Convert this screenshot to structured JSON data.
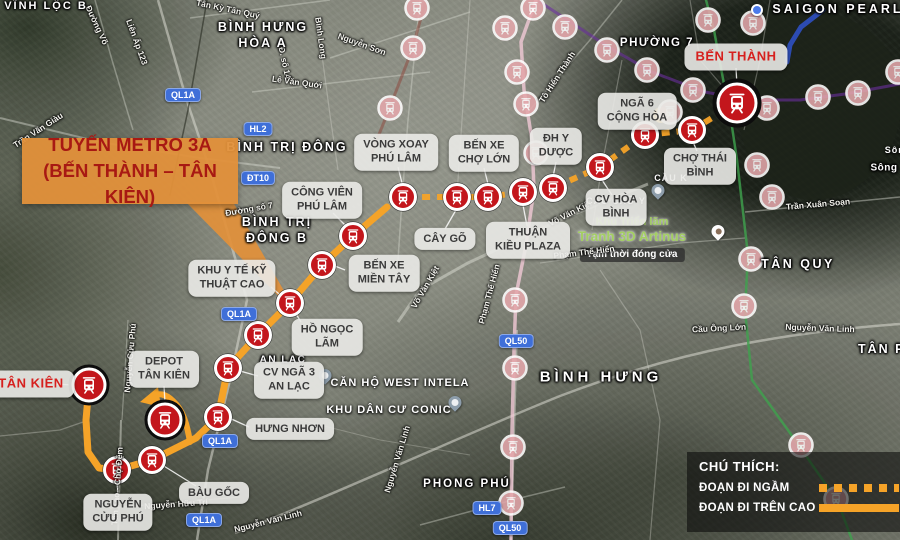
{
  "callout": {
    "line1": "TUYẾN METRO 3A",
    "line2": "(BẾN THÀNH – TÂN KIÊN)",
    "bg": "#e2903a",
    "pointer": [
      [
        186,
        202
      ],
      [
        233,
        202
      ],
      [
        299,
        317
      ]
    ]
  },
  "legend": {
    "title": "CHÚ THÍCH:",
    "items": [
      {
        "label": "ĐOẠN ĐI NGẦM",
        "style": "dashed"
      },
      {
        "label": "ĐOẠN ĐI TRÊN CAO",
        "style": "solid"
      }
    ]
  },
  "colors": {
    "route_orange": "#f5a328",
    "station_red": "#c3161c",
    "faded_pink": "#e4a7ab",
    "badge_blue": "#3f6fd8",
    "callout_text": "#a81913"
  },
  "route": {
    "color": "#f5a328",
    "dotted": [
      [
        737,
        103
      ],
      [
        692,
        130
      ],
      [
        645,
        135
      ],
      [
        600,
        167
      ],
      [
        553,
        188
      ],
      [
        523,
        192
      ],
      [
        488,
        197
      ],
      [
        457,
        197
      ],
      [
        403,
        197
      ],
      [
        387,
        207
      ]
    ],
    "solid": [
      [
        387,
        207
      ],
      [
        353,
        236
      ],
      [
        322,
        265
      ],
      [
        290,
        303
      ],
      [
        258,
        335
      ],
      [
        228,
        368
      ],
      [
        218,
        417
      ],
      [
        196,
        438
      ],
      [
        152,
        460
      ],
      [
        117,
        470
      ],
      [
        99,
        468
      ],
      [
        88,
        452
      ],
      [
        86,
        420
      ],
      [
        89,
        385
      ]
    ],
    "depot_branch": "M190,442 C187,424 183,410 173,401 C166,394 158,392 152,397",
    "arrow": [
      [
        140,
        402
      ],
      [
        158,
        387
      ],
      [
        161,
        407
      ]
    ]
  },
  "stations": {
    "terminals": [
      {
        "name": "Bến Thành",
        "x": 737,
        "y": 103,
        "r": 19,
        "glyph": 24,
        "ring": 5
      },
      {
        "name": "Tân Kiên",
        "x": 89,
        "y": 385,
        "r": 16,
        "glyph": 20,
        "ring": 4
      },
      {
        "name": "Depot Tân Kiên",
        "x": 165,
        "y": 420,
        "r": 16,
        "glyph": 20,
        "ring": 4
      }
    ],
    "line": [
      [
        692,
        130
      ],
      [
        645,
        135
      ],
      [
        600,
        167
      ],
      [
        553,
        188
      ],
      [
        523,
        192
      ],
      [
        488,
        197
      ],
      [
        457,
        197
      ],
      [
        403,
        197
      ],
      [
        353,
        236
      ],
      [
        322,
        265
      ],
      [
        290,
        303
      ],
      [
        258,
        335
      ],
      [
        228,
        368
      ],
      [
        218,
        417
      ],
      [
        152,
        460
      ],
      [
        117,
        470
      ]
    ],
    "faded": [
      [
        417,
        8
      ],
      [
        413,
        48
      ],
      [
        390,
        108
      ],
      [
        533,
        8
      ],
      [
        505,
        28
      ],
      [
        517,
        72
      ],
      [
        526,
        104
      ],
      [
        536,
        153
      ],
      [
        515,
        300
      ],
      [
        515,
        368
      ],
      [
        513,
        447
      ],
      [
        511,
        503
      ],
      [
        565,
        27
      ],
      [
        607,
        50
      ],
      [
        647,
        70
      ],
      [
        693,
        90
      ],
      [
        670,
        112
      ],
      [
        708,
        20
      ],
      [
        753,
        23
      ],
      [
        767,
        108
      ],
      [
        757,
        165
      ],
      [
        772,
        197
      ],
      [
        751,
        259
      ],
      [
        744,
        306
      ],
      [
        801,
        445
      ],
      [
        836,
        499
      ],
      [
        818,
        97
      ],
      [
        858,
        93
      ],
      [
        898,
        72
      ]
    ]
  },
  "station_labels": [
    {
      "lines": [
        "BẾN THÀNH"
      ],
      "x": 736,
      "y": 57,
      "red": true
    },
    {
      "lines": [
        "NGÃ 6",
        "CỘNG HÒA"
      ],
      "x": 637,
      "y": 111
    },
    {
      "lines": [
        "CHỢ THÁI",
        "BÌNH"
      ],
      "x": 700,
      "y": 166
    },
    {
      "lines": [
        "ĐH Y",
        "DƯỢC"
      ],
      "x": 556,
      "y": 146
    },
    {
      "lines": [
        "BẾN XE",
        "CHỢ LỚN"
      ],
      "x": 484,
      "y": 153
    },
    {
      "lines": [
        "VÒNG XOAY",
        "PHÚ LÂM"
      ],
      "x": 396,
      "y": 152
    },
    {
      "lines": [
        "CÔNG VIÊN",
        "PHÚ LÂM"
      ],
      "x": 322,
      "y": 200
    },
    {
      "lines": [
        "CÂY GÕ"
      ],
      "x": 445,
      "y": 239
    },
    {
      "lines": [
        "THUẬN",
        "KIỀU PLAZA"
      ],
      "x": 528,
      "y": 240
    },
    {
      "lines": [
        "CV HÒA",
        "BÌNH"
      ],
      "x": 616,
      "y": 207
    },
    {
      "lines": [
        "BẾN XE",
        "MIỀN TÂY"
      ],
      "x": 384,
      "y": 273
    },
    {
      "lines": [
        "KHU Y TẾ KỸ",
        "THUẬT CAO"
      ],
      "x": 232,
      "y": 278
    },
    {
      "lines": [
        "HỒ NGỌC",
        "LÃM"
      ],
      "x": 327,
      "y": 337
    },
    {
      "lines": [
        "CV NGÃ 3",
        "AN LẠC"
      ],
      "x": 289,
      "y": 380
    },
    {
      "lines": [
        "HƯNG NHƠN"
      ],
      "x": 290,
      "y": 429
    },
    {
      "lines": [
        "BÀU GỐC"
      ],
      "x": 214,
      "y": 493
    },
    {
      "lines": [
        "NGUYỄN",
        "CỬU PHÚ"
      ],
      "x": 118,
      "y": 512
    },
    {
      "lines": [
        "DEPOT",
        "TÂN KIÊN"
      ],
      "x": 164,
      "y": 369
    },
    {
      "lines": [
        "TÂN KIÊN"
      ],
      "x": 31,
      "y": 384,
      "red": true
    }
  ],
  "leaders": [
    [
      736,
      68,
      737,
      86
    ],
    [
      697,
      151,
      693,
      142
    ],
    [
      556,
      162,
      553,
      177
    ],
    [
      484,
      168,
      488,
      184
    ],
    [
      398,
      167,
      403,
      187
    ],
    [
      445,
      229,
      456,
      210
    ],
    [
      527,
      226,
      523,
      205
    ],
    [
      612,
      195,
      602,
      180
    ],
    [
      333,
      213,
      349,
      229
    ],
    [
      345,
      270,
      335,
      266
    ],
    [
      271,
      287,
      286,
      300
    ],
    [
      301,
      322,
      293,
      309
    ],
    [
      258,
      376,
      233,
      369
    ],
    [
      249,
      427,
      227,
      417
    ],
    [
      196,
      486,
      159,
      463
    ],
    [
      118,
      499,
      117,
      481
    ],
    [
      164,
      386,
      165,
      403
    ],
    [
      55,
      384,
      72,
      385
    ]
  ],
  "place_names": [
    {
      "text": "VĨNH LỘC B",
      "x": 46,
      "y": 6,
      "size": 11,
      "ls": 2
    },
    {
      "text": "BÌNH HƯNG",
      "x": 263,
      "y": 27,
      "size": 12.5,
      "ls": 2
    },
    {
      "text": "HÒA A",
      "x": 263,
      "y": 43,
      "size": 12.5,
      "ls": 2
    },
    {
      "text": "PHƯỜNG 7",
      "x": 657,
      "y": 43,
      "size": 11.5,
      "ls": 1.5
    },
    {
      "text": "SAIGON PEARL",
      "x": 838,
      "y": 9,
      "size": 12.5,
      "ls": 3
    },
    {
      "text": "BÌNH TRỊ ĐÔNG",
      "x": 287,
      "y": 147,
      "size": 12.5,
      "ls": 2
    },
    {
      "text": "BÌNH TRỊ",
      "x": 277,
      "y": 222,
      "size": 12.5,
      "ls": 2
    },
    {
      "text": "ĐÔNG B",
      "x": 277,
      "y": 238,
      "size": 12.5,
      "ls": 2
    },
    {
      "text": "TÂN QUY",
      "x": 798,
      "y": 264,
      "size": 12.5,
      "ls": 2.5
    },
    {
      "text": "BÌNH HƯNG",
      "x": 601,
      "y": 377,
      "size": 15,
      "ls": 4
    },
    {
      "text": "PHONG PHÚ",
      "x": 467,
      "y": 484,
      "size": 11.5,
      "ls": 2
    },
    {
      "text": "TÂN PHONG",
      "x": 858,
      "y": 349,
      "size": 12.5,
      "ls": 2,
      "anchor": "left"
    },
    {
      "text": "AN LẠC",
      "x": 283,
      "y": 360,
      "size": 10,
      "ls": 1.5
    },
    {
      "text": "Sông",
      "x": 884,
      "y": 168,
      "size": 10,
      "ls": 0.5
    }
  ],
  "road_labels": [
    {
      "t": "Trần Văn Giàu",
      "x": 38,
      "y": 130,
      "r": -33
    },
    {
      "t": "Đường Võ",
      "x": 97,
      "y": 25,
      "r": 65
    },
    {
      "t": "Liên Ấp 123",
      "x": 137,
      "y": 42,
      "r": 70
    },
    {
      "t": "Tân Kỳ Tân Quý",
      "x": 228,
      "y": 9,
      "r": 12
    },
    {
      "t": "Đ. số 14",
      "x": 285,
      "y": 63,
      "r": 78
    },
    {
      "t": "Bình Long",
      "x": 321,
      "y": 38,
      "r": 82
    },
    {
      "t": "Nguyễn Sơn",
      "x": 362,
      "y": 44,
      "r": 20
    },
    {
      "t": "Lê Văn Quới",
      "x": 297,
      "y": 82,
      "r": 8
    },
    {
      "t": "Tô Hiến Thành",
      "x": 557,
      "y": 77,
      "r": -57
    },
    {
      "t": "Đường số 7",
      "x": 249,
      "y": 209,
      "r": -10
    },
    {
      "t": "Võ Văn Kiệt",
      "x": 425,
      "y": 287,
      "r": -60
    },
    {
      "t": "Võ Văn Kiệt",
      "x": 570,
      "y": 213,
      "r": -27
    },
    {
      "t": "Trần Xuân Soạn",
      "x": 818,
      "y": 204,
      "r": -5
    },
    {
      "t": "Nguyễn Văn Linh",
      "x": 820,
      "y": 328,
      "r": 2
    },
    {
      "t": "Cầu Ông Lớn",
      "x": 719,
      "y": 328,
      "r": -3
    },
    {
      "t": "Nguyễn Văn Linh",
      "x": 268,
      "y": 521,
      "r": -14
    },
    {
      "t": "Nguyễn Hữu Trí",
      "x": 176,
      "y": 504,
      "r": -4
    },
    {
      "t": "Nguyễn Cửu Phú",
      "x": 130,
      "y": 358,
      "r": -85
    },
    {
      "t": "Tân Tạo - Chợ Đệm",
      "x": 117,
      "y": 486,
      "r": -86
    },
    {
      "t": "Phạm Thế Hiển",
      "x": 584,
      "y": 252,
      "r": -7
    },
    {
      "t": "Phạm Thế Hiển",
      "x": 489,
      "y": 294,
      "r": -75
    },
    {
      "t": "Nguyễn Văn Linh",
      "x": 397,
      "y": 459,
      "r": -73
    }
  ],
  "badges": [
    {
      "t": "QL1A",
      "x": 183,
      "y": 95
    },
    {
      "t": "QL1A",
      "x": 239,
      "y": 314
    },
    {
      "t": "QL1A",
      "x": 220,
      "y": 441
    },
    {
      "t": "QL1A",
      "x": 204,
      "y": 520
    },
    {
      "t": "HL2",
      "x": 258,
      "y": 129
    },
    {
      "t": "ĐT10",
      "x": 258,
      "y": 178
    },
    {
      "t": "QL50",
      "x": 516,
      "y": 341
    },
    {
      "t": "QL50",
      "x": 510,
      "y": 528
    },
    {
      "t": "HL7",
      "x": 487,
      "y": 508
    }
  ],
  "poi": {
    "artinus": {
      "line1": "Khu Triển lãm",
      "line2": "Tranh 3D Artinus",
      "line3": "Tạm thời đóng cửa"
    }
  },
  "poi_texts": [
    {
      "text": "CĂN HỘ WEST INTELA",
      "x": 400,
      "y": 383,
      "size": 11
    },
    {
      "text": "KHU DÂN CƯ CONIC",
      "x": 389,
      "y": 410,
      "size": 11
    },
    {
      "text": "CẦU CHỮ Y",
      "x": 616,
      "y": 201,
      "size": 9
    },
    {
      "text": "CẦU K",
      "x": 671,
      "y": 178,
      "size": 9
    },
    {
      "text": "Sông",
      "x": 898,
      "y": 150,
      "size": 9
    }
  ],
  "pins": [
    {
      "x": 325,
      "y": 382,
      "kind": "grey",
      "name": "west-intela-pin"
    },
    {
      "x": 455,
      "y": 409,
      "kind": "grey",
      "name": "conic-pin"
    },
    {
      "x": 658,
      "y": 197,
      "kind": "grey",
      "name": "bridge-pin"
    },
    {
      "x": 718,
      "y": 238,
      "kind": "palette",
      "name": "artinus-pin"
    },
    {
      "x": 757,
      "y": 10,
      "kind": "blue",
      "name": "poi-pin"
    }
  ],
  "map": {
    "roundabout": [
      661,
      115
    ],
    "water": [
      "M742,12 C810,-5 880,18 898,70 C912,118 888,178 838,196 C788,212 748,176 740,128 C736,94 734,40 742,12 Z"
    ],
    "roads": [
      {
        "d": "M158,0 L186,98 L210,170 L247,300 L230,380 L208,470 L197,540",
        "w": 2.5,
        "o": 0.55
      },
      {
        "d": "M648,184 L560,220 L468,263 L420,290 L398,322",
        "w": 3,
        "o": 0.5
      },
      {
        "d": "M900,324 C790,332 680,350 560,396 C470,432 330,497 235,533",
        "w": 2.5,
        "o": 0.55
      },
      {
        "d": "M517,330 L511,540",
        "w": 2,
        "o": 0.5
      },
      {
        "d": "M420,0 L408,120 L402,200 L398,260",
        "w": 1.5,
        "o": 0.4
      },
      {
        "d": "M470,0 L462,120 L457,195",
        "w": 1.2,
        "o": 0.35
      },
      {
        "d": "M622,60 L602,165 L592,230",
        "w": 1.2,
        "o": 0.35
      },
      {
        "d": "M252,92 L430,72",
        "w": 1.5,
        "o": 0.4
      },
      {
        "d": "M330,58 L470,12",
        "w": 1.5,
        "o": 0.4
      },
      {
        "d": "M190,18 L330,0",
        "w": 1.5,
        "o": 0.4
      },
      {
        "d": "M317,18 L330,115 L338,170",
        "w": 1.2,
        "o": 0.35
      },
      {
        "d": "M0,118 L100,142 L200,158 L280,168",
        "w": 2,
        "o": 0.45
      },
      {
        "d": "M528,112 L590,40 L622,0",
        "w": 1.5,
        "o": 0.4
      },
      {
        "d": "M745,212 L900,197",
        "w": 1.5,
        "o": 0.45
      },
      {
        "d": "M540,263 L680,243 L745,238",
        "w": 1.2,
        "o": 0.4
      },
      {
        "d": "M420,525 L520,498 L565,487",
        "w": 1.5,
        "o": 0.4
      },
      {
        "d": "M110,508 L240,497",
        "w": 1.2,
        "o": 0.4
      },
      {
        "d": "M121,420 L118,540",
        "w": 2,
        "o": 0.5
      },
      {
        "d": "M95,0 L112,60 L133,130",
        "w": 1.5,
        "o": 0.4
      },
      {
        "d": "M0,436 L60,430 L86,421",
        "w": 1.2,
        "o": 0.35
      },
      {
        "d": "M128,320 L122,420",
        "w": 1.2,
        "o": 0.4
      },
      {
        "d": "M770,0 L760,60 L744,130",
        "w": 1.2,
        "o": 0.35
      },
      {
        "d": "M600,270 L640,330 L660,420 L650,540",
        "w": 1.2,
        "o": 0.35
      },
      {
        "d": "M300,420 L380,440 L470,455",
        "w": 1,
        "o": 0.3
      },
      {
        "d": "M737,103 L700,60 L690,0",
        "w": 1.2,
        "o": 0.35
      }
    ]
  },
  "other_lines": [
    {
      "pts": [
        [
          207,
          0
        ],
        [
          188,
          110
        ],
        [
          170,
          195
        ]
      ],
      "c": "#26291f",
      "w": 1.5,
      "o": 0.6
    },
    {
      "pts": [
        [
          426,
          0
        ],
        [
          412,
          50
        ],
        [
          388,
          112
        ],
        [
          372,
          152
        ]
      ],
      "c": "#8d4b40",
      "w": 3,
      "o": 0.55
    },
    {
      "pts": [
        [
          536,
          0
        ],
        [
          521,
          42
        ],
        [
          524,
          90
        ],
        [
          532,
          140
        ],
        [
          534,
          190
        ],
        [
          526,
          245
        ],
        [
          516,
          295
        ],
        [
          514,
          350
        ],
        [
          512,
          430
        ],
        [
          511,
          540
        ]
      ],
      "c": "#f1c9d6",
      "w": 3.5,
      "o": 0.8
    },
    {
      "pts": [
        [
          540,
          2
        ],
        [
          610,
          48
        ],
        [
          652,
          72
        ],
        [
          705,
          92
        ],
        [
          748,
          100
        ],
        [
          800,
          100
        ],
        [
          845,
          94
        ],
        [
          900,
          84
        ]
      ],
      "c": "#6a2e9e",
      "w": 3,
      "o": 0.6
    },
    {
      "pts": [
        [
          706,
          0
        ],
        [
          714,
          30
        ],
        [
          719,
          58
        ],
        [
          731,
          120
        ],
        [
          737,
          160
        ],
        [
          748,
          255
        ],
        [
          745,
          310
        ],
        [
          752,
          380
        ],
        [
          795,
          440
        ],
        [
          838,
          502
        ],
        [
          852,
          540
        ]
      ],
      "c": "#3fa34d",
      "w": 2.5,
      "o": 0.8
    },
    {
      "pts": [
        [
          823,
          10
        ],
        [
          801,
          27
        ],
        [
          790,
          45
        ],
        [
          787,
          62
        ]
      ],
      "c": "#2f52cc",
      "w": 5,
      "o": 0.85
    }
  ]
}
